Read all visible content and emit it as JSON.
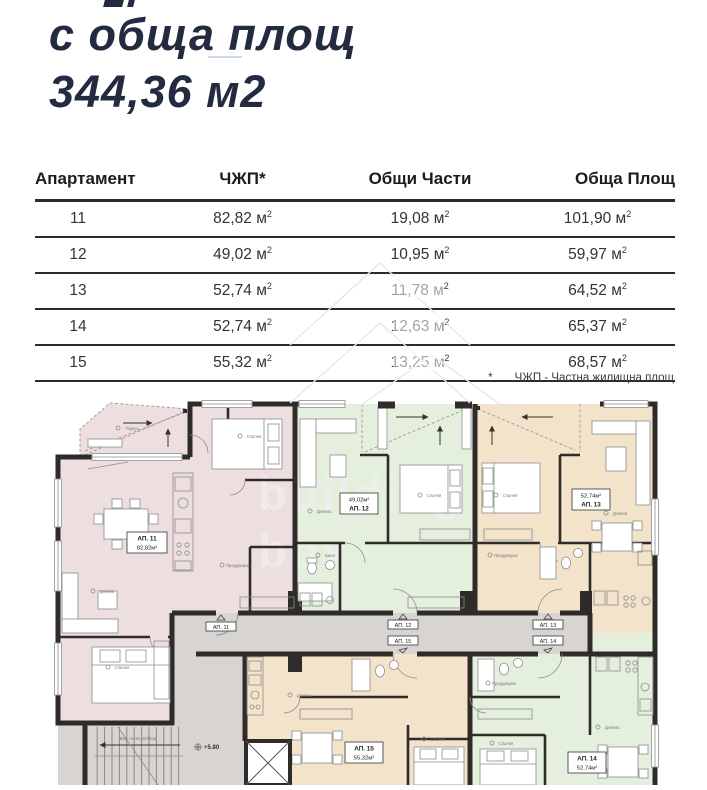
{
  "title": {
    "line1": "с обща площ",
    "line2": "344,36 м2"
  },
  "table": {
    "columns": [
      "Апартамент",
      "ЧЖП*",
      "Общи Части",
      "Обща Площ"
    ],
    "unit": " м",
    "sup": "2",
    "rows": [
      {
        "apartment": "11",
        "chzhp": "82,82",
        "common": "19,08",
        "total": "101,90"
      },
      {
        "apartment": "12",
        "chzhp": "49,02",
        "common": "10,95",
        "total": "59,97"
      },
      {
        "apartment": "13",
        "chzhp": "52,74",
        "common": "11,78",
        "total": "64,52"
      },
      {
        "apartment": "14",
        "chzhp": "52,74",
        "common": "12,63",
        "total": "65,37"
      },
      {
        "apartment": "15",
        "chzhp": "55,32",
        "common": "13,25",
        "total": "68,57"
      }
    ],
    "footnote_star": "*",
    "footnote": "ЧЖП - Частна жилищна площ"
  },
  "floorplan": {
    "watermark": {
      "line1": "building",
      "line2": "box"
    },
    "level_mark": "+5.80",
    "stairs_note": "Вис. на 16,15/28см",
    "apartments": [
      {
        "id": "11",
        "label": "АП. 11",
        "area": "82,82м²",
        "color": "#eddfdf"
      },
      {
        "id": "12",
        "label": "АП. 12",
        "area": "49,02м²",
        "color": "#e4efde"
      },
      {
        "id": "13",
        "label": "АП. 13",
        "area": "52,74м²",
        "color": "#f4e3cb"
      },
      {
        "id": "14",
        "label": "АП. 14",
        "area": "52,74м²",
        "color": "#e4efde"
      },
      {
        "id": "15",
        "label": "АП. 15",
        "area": "55,32м²",
        "color": "#f4e3cb"
      }
    ],
    "corridor_labels": [
      "АП. 11",
      "АП. 12",
      "АП. 15",
      "АП. 13",
      "АП. 14"
    ],
    "room_labels": [
      "Тераса",
      "Спалня",
      "Дневна",
      "Преддверие",
      "Спалня",
      "Дневна",
      "Спалня",
      "Баня",
      "Спалня",
      "Дневна",
      "Преддверие",
      "Дневна",
      "Спалня",
      "Преддверие",
      "Спалня",
      "Дневна"
    ]
  },
  "colors": {
    "title_navy": "#222b40",
    "table_line": "#272d33",
    "wall": "#2e2b28",
    "corridor_gray": "#d7d4d1",
    "pink": "#eddfdf",
    "green": "#e4efde",
    "beige": "#f4e3cb"
  }
}
